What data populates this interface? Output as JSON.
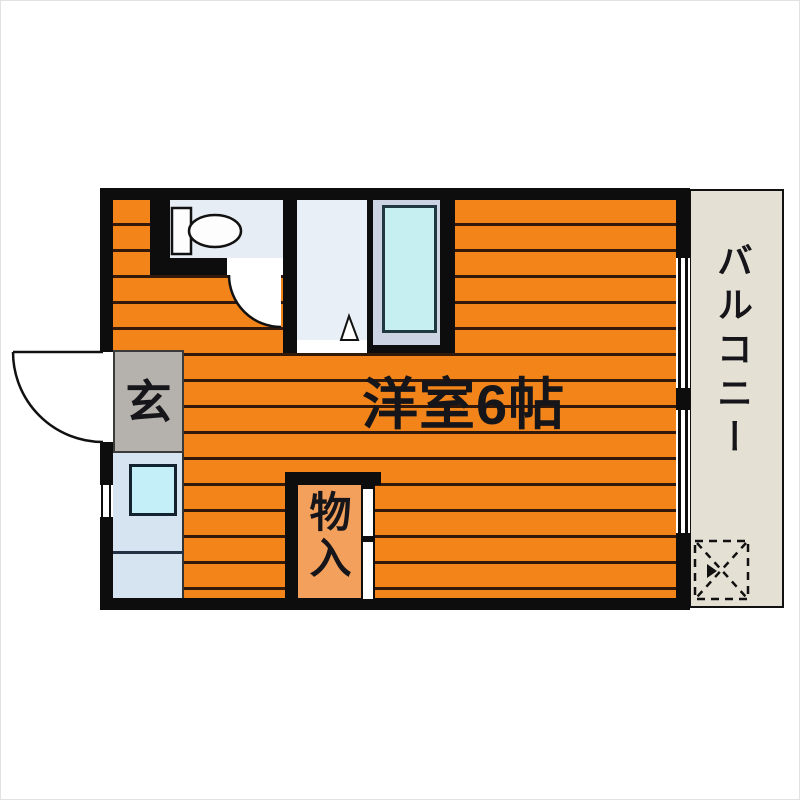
{
  "floorplan": {
    "type": "apartment-floor-plan",
    "main_room": {
      "label": "洋室6帖"
    },
    "balcony": {
      "label": "バルコニー"
    },
    "entrance": {
      "label": "玄"
    },
    "storage": {
      "label": "物入"
    },
    "colors": {
      "flooring_orange": "#f2841a",
      "floor_stripe": "#33190a",
      "wall_black": "#0d0d0d",
      "toilet_room_floor": "#e7edf4",
      "bathroom_floor": "#e9eff6",
      "bathtub_fill": "#c6eff2",
      "bathtub_frame": "#ccd3e2",
      "entrance_floor": "#b5b1ac",
      "kitchen_floor": "#d6e4f2",
      "sink_square": "#c4eef8",
      "storage_floor": "#f2a05c",
      "balcony_floor": "#e5e0d4",
      "label_text": "#15151a"
    }
  }
}
